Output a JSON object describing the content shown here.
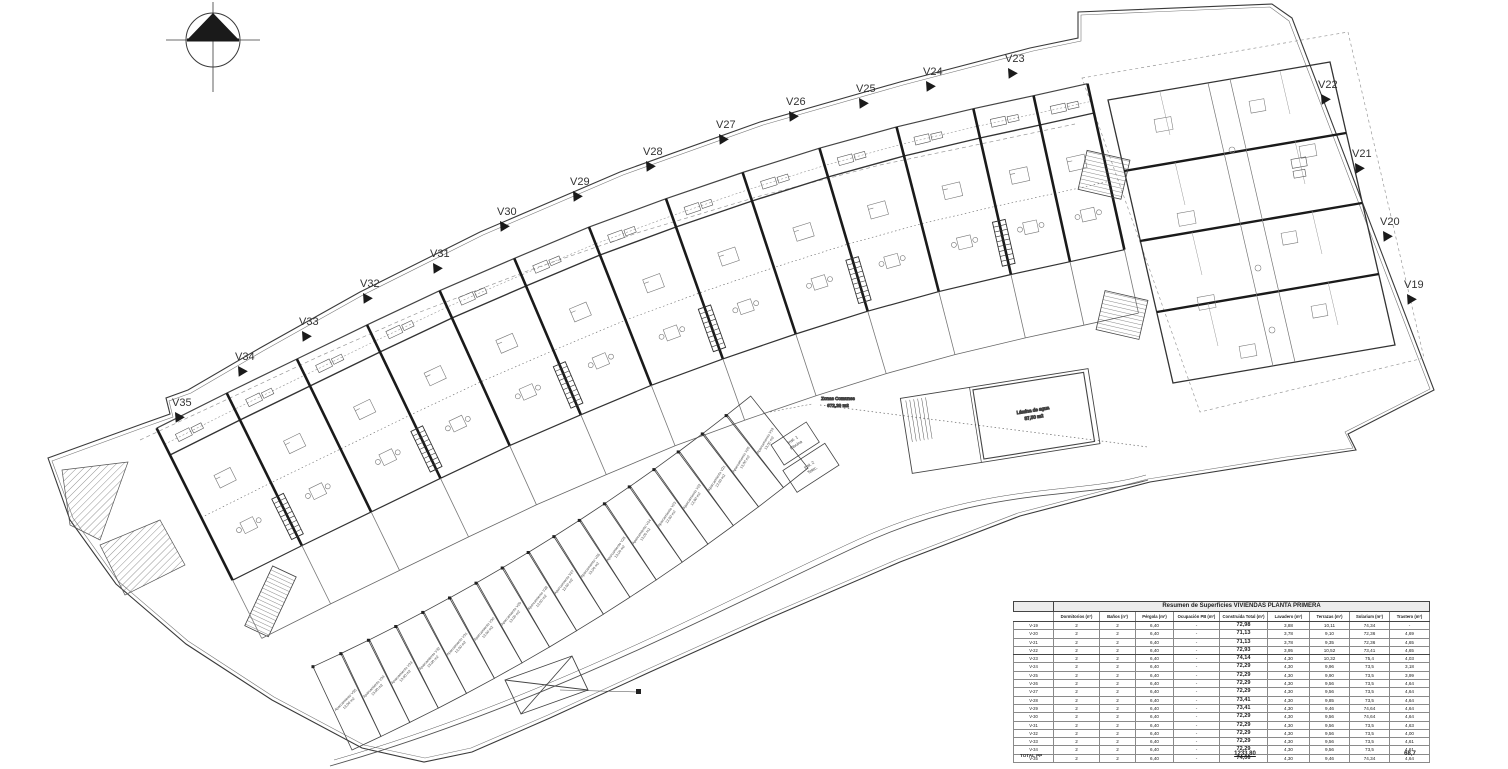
{
  "plan": {
    "icons": {
      "compass": "north-arrow"
    },
    "villa_labels": [
      {
        "id": "V19",
        "x": 1404,
        "y": 288
      },
      {
        "id": "V20",
        "x": 1380,
        "y": 225
      },
      {
        "id": "V21",
        "x": 1352,
        "y": 157
      },
      {
        "id": "V22",
        "x": 1318,
        "y": 88
      },
      {
        "id": "V23",
        "x": 1005,
        "y": 62
      },
      {
        "id": "V24",
        "x": 923,
        "y": 75
      },
      {
        "id": "V25",
        "x": 856,
        "y": 92
      },
      {
        "id": "V26",
        "x": 786,
        "y": 105
      },
      {
        "id": "V27",
        "x": 716,
        "y": 128
      },
      {
        "id": "V28",
        "x": 643,
        "y": 155
      },
      {
        "id": "V29",
        "x": 570,
        "y": 185
      },
      {
        "id": "V30",
        "x": 497,
        "y": 215
      },
      {
        "id": "V31",
        "x": 430,
        "y": 257
      },
      {
        "id": "V32",
        "x": 360,
        "y": 287
      },
      {
        "id": "V33",
        "x": 299,
        "y": 325
      },
      {
        "id": "V34",
        "x": 235,
        "y": 360
      },
      {
        "id": "V35",
        "x": 172,
        "y": 406
      }
    ],
    "annotations": {
      "zonas_1": "Zonas Comunes",
      "zonas_2": "672,29 m2",
      "lamina_1": "Lámina de agua",
      "lamina_2": "87,50 m2",
      "inst1_1": "Inst. 1",
      "inst1_2": "Piscina",
      "inst2_1": "Inst. 2",
      "inst2_2": "Telec."
    },
    "parking": [
      {
        "id": "V35",
        "label": "Aparcamiento V35",
        "area": "13,00 m2"
      },
      {
        "id": "V34",
        "label": "Aparcamiento V34",
        "area": "13,00 m2"
      },
      {
        "id": "V33",
        "label": "Aparcamiento V33",
        "area": "13,00 m2"
      },
      {
        "id": "V32",
        "label": "Aparcamiento V32",
        "area": "13,00 m2"
      },
      {
        "id": "V31",
        "label": "Aparcamiento V31",
        "area": "13,00 m2"
      },
      {
        "id": "V30",
        "label": "Aparcamiento V30",
        "area": "13,00 m2"
      },
      {
        "id": "V29",
        "label": "Aparcamiento V29",
        "area": "13,00 m2"
      },
      {
        "id": "V28",
        "label": "Aparcamiento V28",
        "area": "13,00 m2"
      },
      {
        "id": "V27",
        "label": "Aparcamiento V27",
        "area": "13,00 m2"
      },
      {
        "id": "V26",
        "label": "Aparcamiento V26",
        "area": "13,00 m2"
      },
      {
        "id": "V25",
        "label": "Aparcamiento V25",
        "area": "13,00 m2"
      },
      {
        "id": "V24",
        "label": "Aparcamiento V24",
        "area": "13,00 m2"
      },
      {
        "id": "V23",
        "label": "Aparcamiento V23",
        "area": "13,00 m2"
      },
      {
        "id": "V22",
        "label": "Aparcamiento V22",
        "area": "13,00 m2"
      },
      {
        "id": "V21",
        "label": "Aparcamiento V21",
        "area": "13,00 m2"
      },
      {
        "id": "V20",
        "label": "Aparcamiento V20",
        "area": "13,00 m2"
      },
      {
        "id": "V19",
        "label": "Aparcamiento V19",
        "area": "13,00 m2"
      }
    ]
  },
  "table": {
    "title": "Resumen de Superficies VIVIENDAS PLANTA PRIMERA",
    "columns": [
      "Dormitorios (nº)",
      "Baños (nº)",
      "Pérgola (m²)",
      "Ocupación PB (m²)",
      "Construida Total (m²)",
      "Lavadero (m²)",
      "Terrazas (m²)",
      "Solarium (m²)",
      "Trastero (m²)"
    ],
    "rows": [
      {
        "id": "V-19",
        "values": [
          "2",
          "2",
          "6,40",
          "-",
          "72,98",
          "3,88",
          "10,11",
          "74,34",
          "-"
        ]
      },
      {
        "id": "V-20",
        "values": [
          "2",
          "2",
          "6,40",
          "-",
          "71,13",
          "3,78",
          "9,10",
          "72,36",
          "4,69"
        ]
      },
      {
        "id": "V-21",
        "values": [
          "2",
          "2",
          "6,40",
          "-",
          "71,13",
          "3,78",
          "9,35",
          "72,36",
          "4,65"
        ]
      },
      {
        "id": "V-22",
        "values": [
          "2",
          "2",
          "6,40",
          "-",
          "72,93",
          "3,95",
          "10,52",
          "73,41",
          "4,65"
        ]
      },
      {
        "id": "V-23",
        "values": [
          "2",
          "2",
          "6,40",
          "-",
          "74,14",
          "4,30",
          "10,32",
          "75,4",
          "4,03"
        ]
      },
      {
        "id": "V-24",
        "values": [
          "2",
          "2",
          "6,40",
          "-",
          "72,29",
          "4,30",
          "9,96",
          "73,5",
          "3,18"
        ]
      },
      {
        "id": "V-25",
        "values": [
          "2",
          "2",
          "6,40",
          "-",
          "72,29",
          "4,30",
          "9,90",
          "73,5",
          "3,99"
        ]
      },
      {
        "id": "V-26",
        "values": [
          "2",
          "2",
          "6,40",
          "-",
          "72,29",
          "4,30",
          "9,56",
          "73,5",
          "4,64"
        ]
      },
      {
        "id": "V-27",
        "values": [
          "2",
          "2",
          "6,40",
          "-",
          "72,29",
          "4,30",
          "9,56",
          "73,5",
          "4,64"
        ]
      },
      {
        "id": "V-28",
        "values": [
          "2",
          "2",
          "6,40",
          "-",
          "73,41",
          "4,30",
          "9,85",
          "73,5",
          "4,64"
        ]
      },
      {
        "id": "V-29",
        "values": [
          "2",
          "2",
          "6,40",
          "-",
          "73,41",
          "4,30",
          "9,46",
          "74,64",
          "4,64"
        ]
      },
      {
        "id": "V-30",
        "values": [
          "2",
          "2",
          "6,40",
          "-",
          "72,29",
          "4,30",
          "9,56",
          "74,64",
          "4,64"
        ]
      },
      {
        "id": "V-31",
        "values": [
          "2",
          "2",
          "6,40",
          "-",
          "72,29",
          "4,30",
          "9,56",
          "73,5",
          "4,63"
        ]
      },
      {
        "id": "V-32",
        "values": [
          "2",
          "2",
          "6,40",
          "-",
          "72,29",
          "4,30",
          "9,56",
          "73,5",
          "4,00"
        ]
      },
      {
        "id": "V-33",
        "values": [
          "2",
          "2",
          "6,40",
          "-",
          "72,29",
          "4,30",
          "9,56",
          "73,5",
          "4,61"
        ]
      },
      {
        "id": "V-34",
        "values": [
          "2",
          "2",
          "6,40",
          "-",
          "72,29",
          "4,30",
          "9,56",
          "73,5",
          "4,61"
        ]
      },
      {
        "id": "V-35",
        "values": [
          "2",
          "2",
          "6,40",
          "-",
          "74,06",
          "4,30",
          "9,46",
          "74,34",
          "4,64"
        ]
      }
    ],
    "total_label": "TOTAL PP",
    "total_construida": "1233,80",
    "total_trastero": "68,7"
  },
  "colors": {
    "line": "#3a3a3a",
    "line_dark": "#1a1a1a",
    "line_light": "#888888",
    "paper": "#ffffff"
  }
}
